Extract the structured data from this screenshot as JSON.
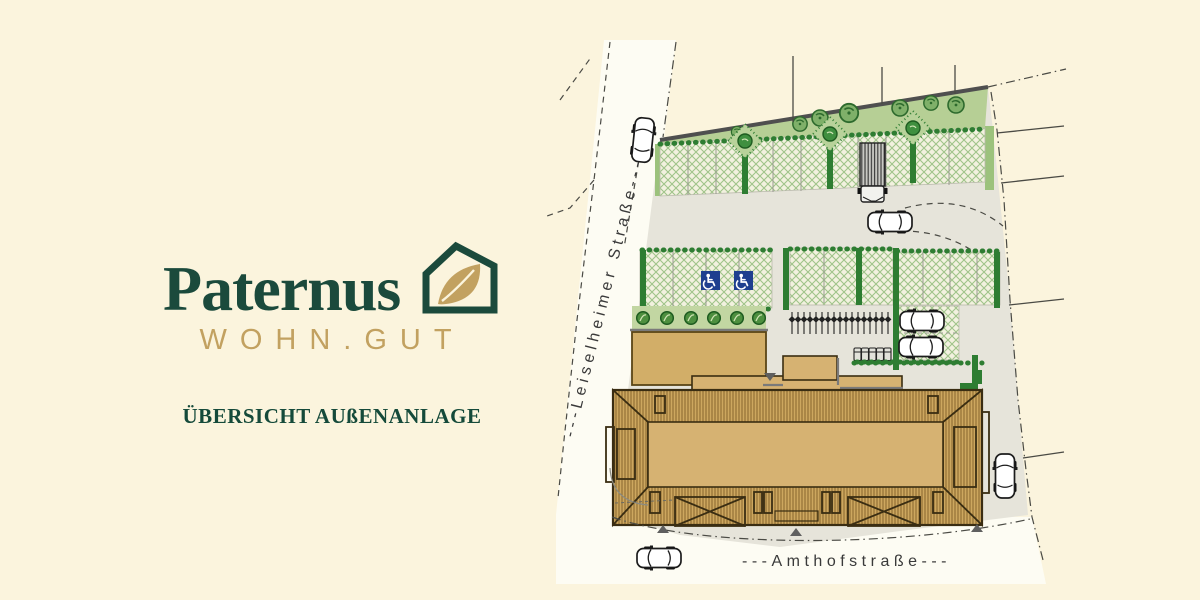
{
  "branding": {
    "logo_text": "Paternus",
    "logo_sub": "WOHN.GUT",
    "title": "ÜBERSICHT AUßENANLAGE",
    "colors": {
      "dark_green": "#1b4a3c",
      "gold": "#c2a160",
      "background": "#fbf4dd"
    }
  },
  "plan": {
    "street_labels": {
      "left": "---Leiselheimer Straße---",
      "bottom": "---Amthofstraße---"
    },
    "colors": {
      "pavement": "#e6e4da",
      "lawn": "#b6cf95",
      "parking_lattice": "#9fc489",
      "hedge_green": "#2e7d32",
      "building_tan": "#d6b272",
      "roof_hatch": "#7e5f26",
      "handicap_blue": "#1e3f8f",
      "street_white": "#fdfcf3"
    },
    "features": {
      "handicap_spaces": 2,
      "top_row_parking_cells": 10,
      "middle_parking_cells": 7,
      "parked_cars": 6,
      "trucks": 1,
      "bike_stands": 17,
      "waste_bins": 5,
      "tree_planters": 3
    }
  }
}
